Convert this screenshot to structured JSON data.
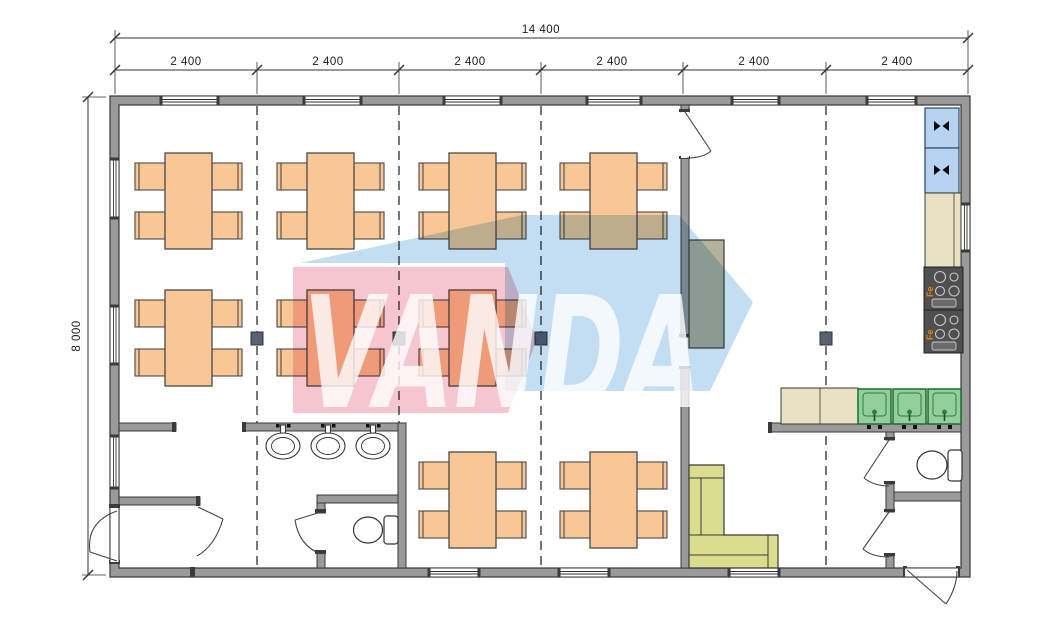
{
  "dimensions": {
    "overall_width": "14 400",
    "height": "8 000",
    "modules": [
      "2 400",
      "2 400",
      "2 400",
      "2 400",
      "2 400",
      "2 400"
    ]
  },
  "watermark": {
    "text": "VANDA",
    "pink_color": "#f5c6cf",
    "blue_color": "#c3def2",
    "text_color": "#ffffff"
  },
  "appliances": {
    "stove_label": "Fe",
    "fridge_count": 2,
    "stove_count": 2,
    "kitchen_sink_count": 3,
    "washbasin_count": 3,
    "toilet_count": 2
  },
  "furniture": {
    "dining_table_count": 9,
    "chairs_per_table": 4,
    "sofa_count": 1
  },
  "colors": {
    "wall": "#9a9a9a",
    "table": "#f9c795",
    "fridge": "#b7d3f2",
    "counter": "#e8e1c3",
    "stove": "#4f4f4f",
    "sink_green": "#93cf9c",
    "sofa": "#d9dd8d",
    "serving_counter": "#b5b29b"
  }
}
